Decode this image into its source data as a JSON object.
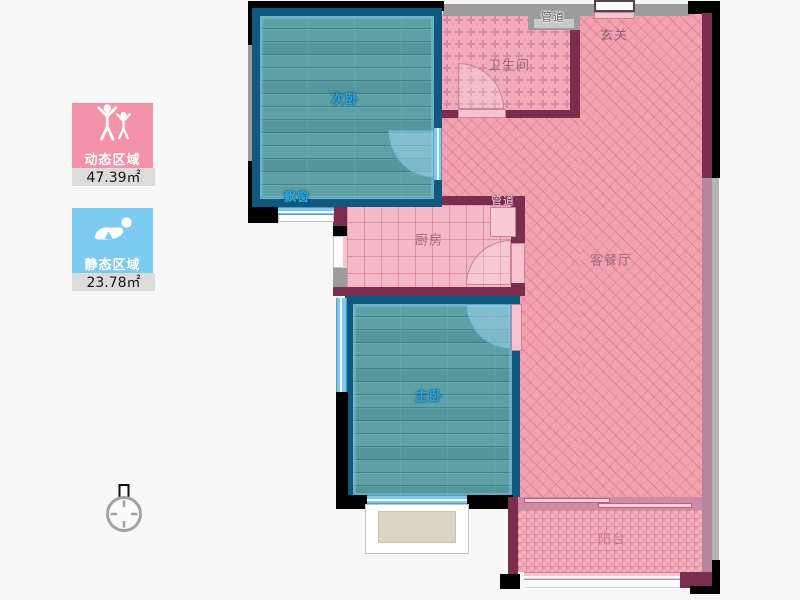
{
  "legend": {
    "items": [
      {
        "id": "dynamic",
        "label": "动态区域",
        "value": "47.39㎡",
        "color": "#f492a8"
      },
      {
        "id": "static",
        "label": "静态区域",
        "value": "23.78㎡",
        "color": "#7ecbf1"
      }
    ]
  },
  "floorplan": {
    "rooms": {
      "secondary_bedroom": "次卧",
      "bay_window": "飘窗",
      "bathroom": "卫生间",
      "duct_top": "管道",
      "entry": "玄关",
      "kitchen": "厨房",
      "duct_kitchen": "管道",
      "living_dining": "客餐厅",
      "master_bedroom": "主卧",
      "balcony": "阳台"
    },
    "zone_colors": {
      "dynamic_zone_fill": "#f2a2ae",
      "static_zone_fill": "#5da0a6",
      "wall_dark_red": "#7b2d4f",
      "wall_blue": "#0f587f",
      "wall_gray": "#9c9c9c",
      "wall_black": "#000000",
      "window_blue": "#7fc7ec"
    }
  }
}
